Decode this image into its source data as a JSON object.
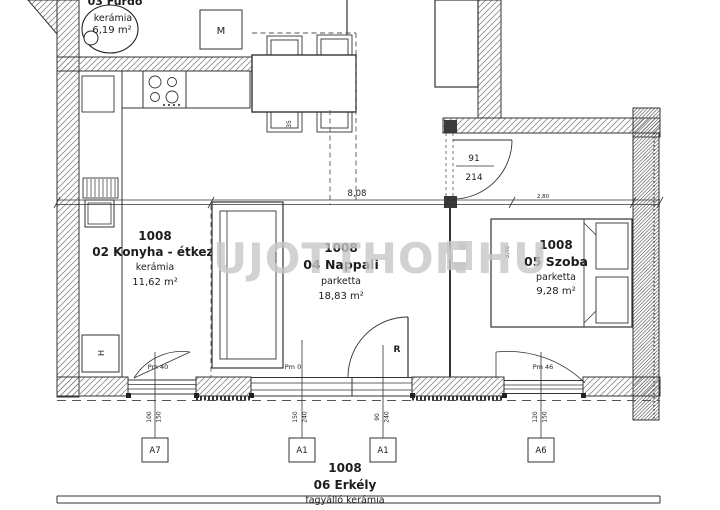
{
  "watermark": {
    "text_left": "UJOTTHON",
    "text_right": "HU"
  },
  "rooms": {
    "bathroom": {
      "name": "03 Fürdő",
      "floor": "kerámia",
      "area": "6,19 m²"
    },
    "kitchen": {
      "unit": "1008",
      "name": "02 Konyha - étkező",
      "floor": "kerámia",
      "area": "11,62 m²"
    },
    "living": {
      "unit": "1008",
      "name": "04 Nappali",
      "floor": "parketta",
      "area": "18,83 m²"
    },
    "bedroom": {
      "unit": "1008",
      "name": "05 Szoba",
      "floor": "parketta",
      "area": "9,28 m²"
    },
    "balcony": {
      "unit": "1008",
      "name": "06 Erkély",
      "floor": "fagyálló kerámia"
    }
  },
  "symbols": {
    "washing_machine": "M",
    "radiator": "H",
    "door_marker": "R"
  },
  "dimensions": {
    "total_width": "8,08",
    "bedroom_width": "2,80",
    "bedroom_depth": "3,40",
    "table": "35",
    "door_width": "91",
    "door_height": "214"
  },
  "parapets": {
    "left": "Pm 40",
    "middle": "Pm 0",
    "right": "Pm 46"
  },
  "openings": [
    {
      "id": "A7",
      "width": "100",
      "height": "150"
    },
    {
      "id": "A1",
      "width": "150",
      "height": "240"
    },
    {
      "id": "A1",
      "width": "90",
      "height": "240"
    },
    {
      "id": "A6",
      "width": "120",
      "height": "150"
    }
  ]
}
